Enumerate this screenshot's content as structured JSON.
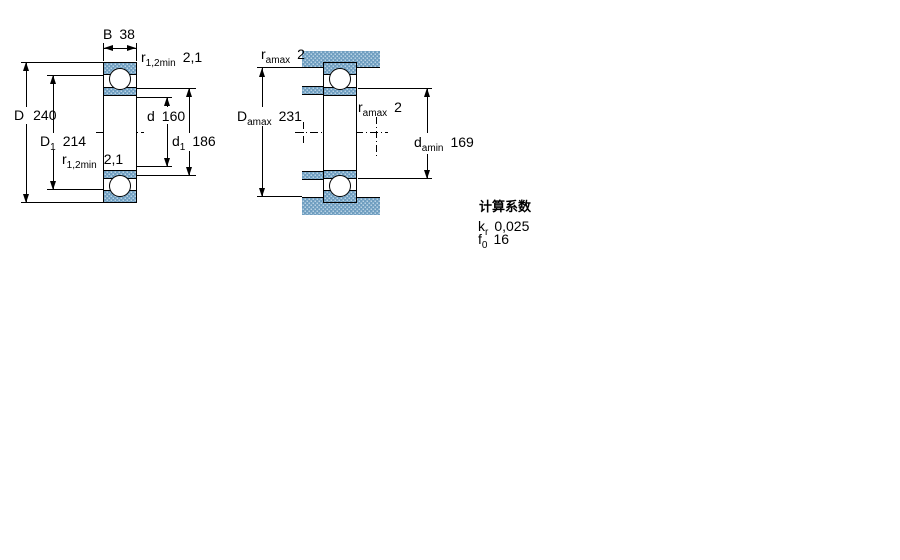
{
  "left_drawing": {
    "B": {
      "main": "B",
      "value": "38"
    },
    "D": {
      "main": "D",
      "value": "240"
    },
    "D1": {
      "main": "D",
      "sub": "1",
      "value": "214"
    },
    "d": {
      "main": "d",
      "value": "160"
    },
    "d1": {
      "main": "d",
      "sub": "1",
      "value": "186"
    },
    "r_top": {
      "main": "r",
      "sub": "1,2min",
      "value": "2,1"
    },
    "r_bottom": {
      "main": "r",
      "sub": "1,2min",
      "value": "2,1"
    }
  },
  "right_drawing": {
    "r_a_top": {
      "main": "r",
      "sub": "amax",
      "value": "2"
    },
    "D_a": {
      "main": "D",
      "sub": "amax",
      "value": "231"
    },
    "r_a_mid": {
      "main": "r",
      "sub": "amax",
      "value": "2"
    },
    "d_a": {
      "main": "d",
      "sub": "amin",
      "value": "169"
    }
  },
  "factors": {
    "title": "计算系数",
    "k": {
      "main": "k",
      "sub": "r",
      "value": "0,025"
    },
    "f": {
      "main": "f",
      "sub": "0",
      "value": "16"
    }
  },
  "colors": {
    "ring_fill": "#b9d3e5",
    "ring_dot": "#6f9ec0",
    "line": "#000000"
  }
}
